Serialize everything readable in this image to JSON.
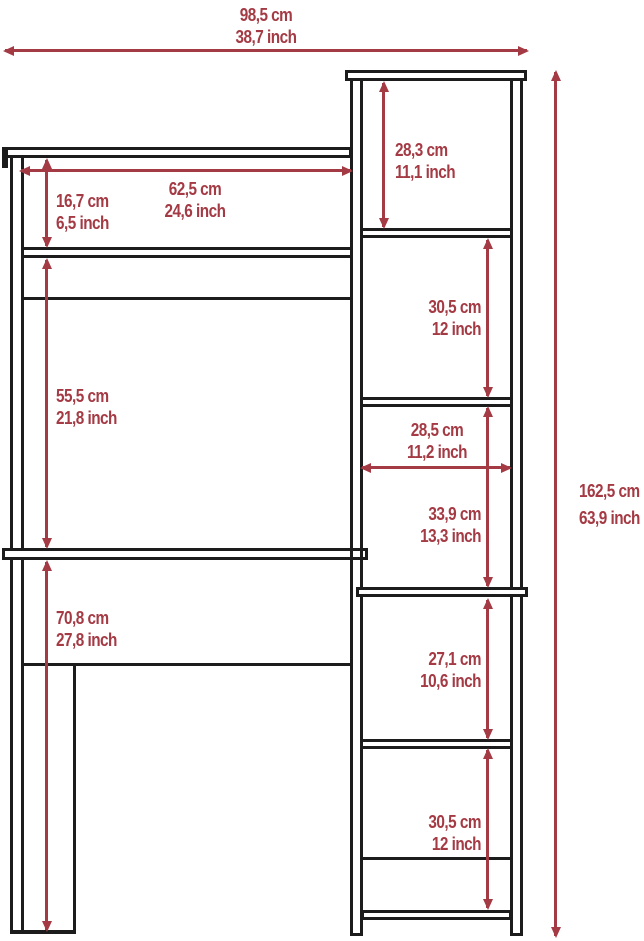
{
  "diagram_title": "furniture dimension diagram",
  "colors": {
    "dimension_red": "#a43a44",
    "outline_black": "#1c1c1c",
    "background": "#ffffff"
  },
  "dimensions": {
    "total_width": {
      "cm": "98,5 cm",
      "inch": "38,7 inch"
    },
    "hutch_opening_width": {
      "cm": "62,5 cm",
      "inch": "24,6 inch"
    },
    "hutch_opening_height": {
      "cm": "16,7 cm",
      "inch": "6,5 inch"
    },
    "shelf_to_desk_height": {
      "cm": "55,5 cm",
      "inch": "21,8 inch"
    },
    "under_desk_clearance": {
      "cm": "70,8 cm",
      "inch": "27,8 inch"
    },
    "tower_top_cubby_height": {
      "cm": "28,3 cm",
      "inch": "11,1 inch"
    },
    "tower_cubby2_height": {
      "cm": "30,5 cm",
      "inch": "12 inch"
    },
    "tower_width": {
      "cm": "28,5 cm",
      "inch": "11,2 inch"
    },
    "tower_cubby3_height": {
      "cm": "33,9 cm",
      "inch": "13,3 inch"
    },
    "tower_cubby4_height": {
      "cm": "27,1 cm",
      "inch": "10,6 inch"
    },
    "tower_cubby5_height": {
      "cm": "30,5 cm",
      "inch": "12 inch"
    },
    "total_height": {
      "cm": "162,5 cm",
      "inch": "63,9 inch"
    }
  }
}
